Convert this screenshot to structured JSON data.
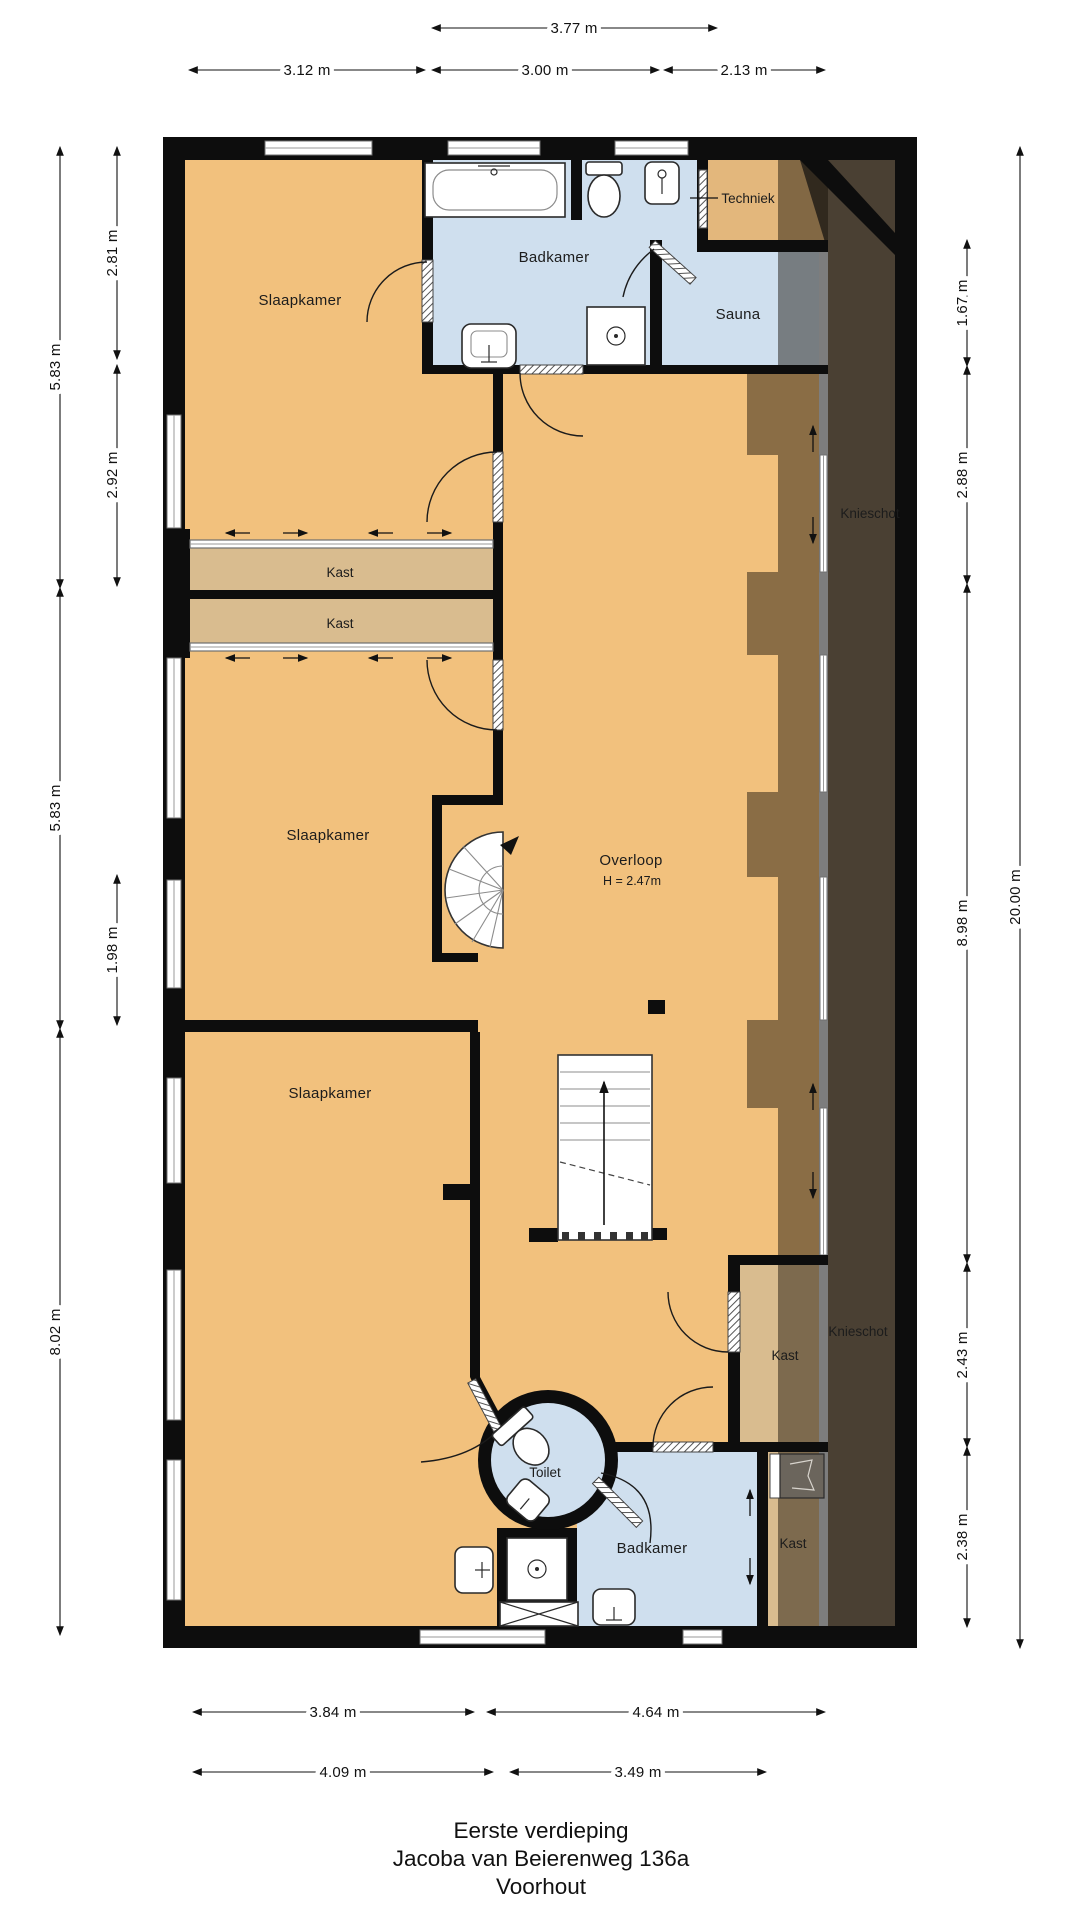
{
  "title_block": {
    "floor": "Eerste verdieping",
    "address": "Jacoba van Beierenweg 136a",
    "city": "Voorhout"
  },
  "room_labels": {
    "slaapkamer1": "Slaapkamer",
    "slaapkamer2": "Slaapkamer",
    "slaapkamer3": "Slaapkamer",
    "badkamer1": "Badkamer",
    "badkamer2": "Badkamer",
    "sauna": "Sauna",
    "techniek": "Techniek",
    "toilet": "Toilet",
    "kast_top1": "Kast",
    "kast_top2": "Kast",
    "kast_low1": "Kast",
    "kast_low2": "Kast",
    "knieschot_top": "Knieschot",
    "knieschot_bottom": "Knieschot",
    "overloop": "Overloop",
    "overloop_height": "H = 2.47m"
  },
  "dimensions": {
    "top_total": "3.77 m",
    "top_left": "3.12 m",
    "top_mid": "3.00 m",
    "top_right": "2.13 m",
    "left_outer": [
      "5.83 m",
      "5.83 m",
      "8.02 m"
    ],
    "left_inner": [
      "2.81 m",
      "2.92 m",
      "1.98 m"
    ],
    "right_inner": [
      "1.67 m",
      "2.88 m",
      "8.98 m",
      "2.43 m",
      "2.38 m"
    ],
    "right_total": "20.00 m",
    "bottom_row1": [
      "3.84 m",
      "4.64 m"
    ],
    "bottom_row2": [
      "4.09 m",
      "3.49 m"
    ]
  },
  "colors": {
    "wall": "#0d0d0d",
    "floor": "#f2c17d",
    "closet": "#d9bc8f",
    "technical": "#e3b77c",
    "wet_room": "#cfdfee",
    "roof_space": "#4a4033"
  }
}
